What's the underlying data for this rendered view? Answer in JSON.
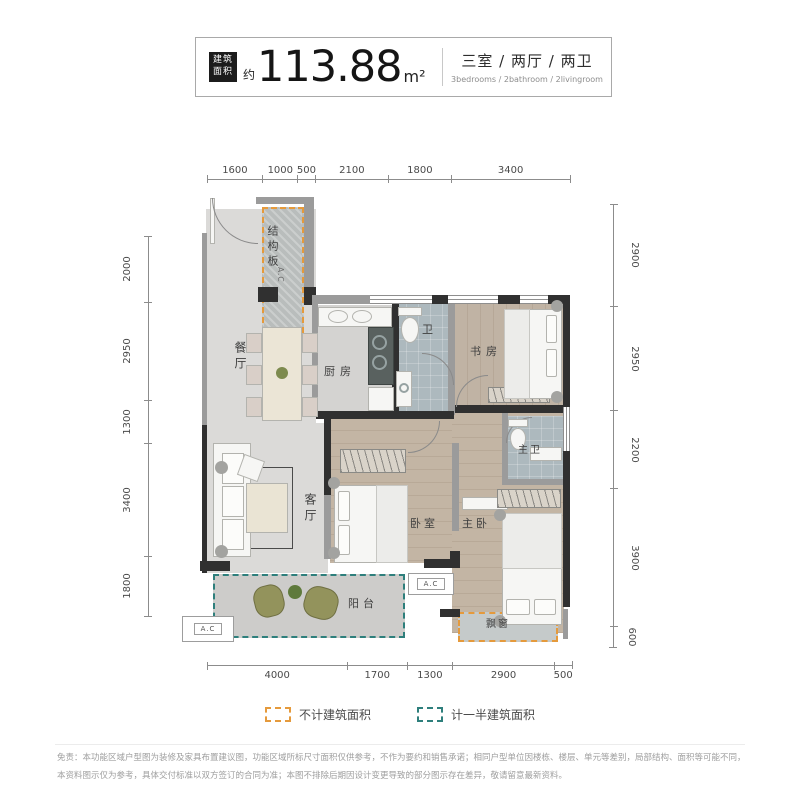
{
  "header": {
    "tag_line1": "建筑",
    "tag_line2": "面积",
    "area_prefix": "约",
    "area_value": "113.88",
    "area_unit": "m²",
    "layout_cn": "三室 / 两厅 / 两卫",
    "layout_en": "3bedrooms / 2bathroom / 2livingroom"
  },
  "dimensions": {
    "top": [
      "1600",
      "1000",
      "500",
      "2100",
      "1800",
      "3400"
    ],
    "bottom": [
      "4000",
      "1700",
      "1300",
      "2900",
      "500"
    ],
    "left": [
      "2000",
      "2950",
      "1300",
      "3400",
      "1800"
    ],
    "right": [
      "2900",
      "2950",
      "2200",
      "3900",
      "600"
    ]
  },
  "rooms": {
    "structure_board": "结构板",
    "ac": "A.C",
    "dining": "餐厅",
    "kitchen": "厨房",
    "bath": "卫",
    "study": "书房",
    "master_bath": "主卫",
    "living": "客厅",
    "bedroom": "卧室",
    "master_bedroom": "主卧",
    "balcony": "阳台",
    "bay_window": "飘窗"
  },
  "legend": {
    "not_counted": "不计建筑面积",
    "half_counted": "计一半建筑面积",
    "orange": "#E59A3C",
    "teal": "#2E7F7C"
  },
  "disclaimer": "免责：本功能区域户型图为装修及家具布置建议图，功能区域所标尺寸面积仅供参考，不作为要约和销售承诺；相同户型单位因楼栋、楼层、单元等差别，局部结构、面积等可能不同，本资料图示仅为参考，具体交付标准以双方签订的合同为准；本图不排除后期因设计变更导致的部分图示存在差异，敬请留意最新资料。"
}
